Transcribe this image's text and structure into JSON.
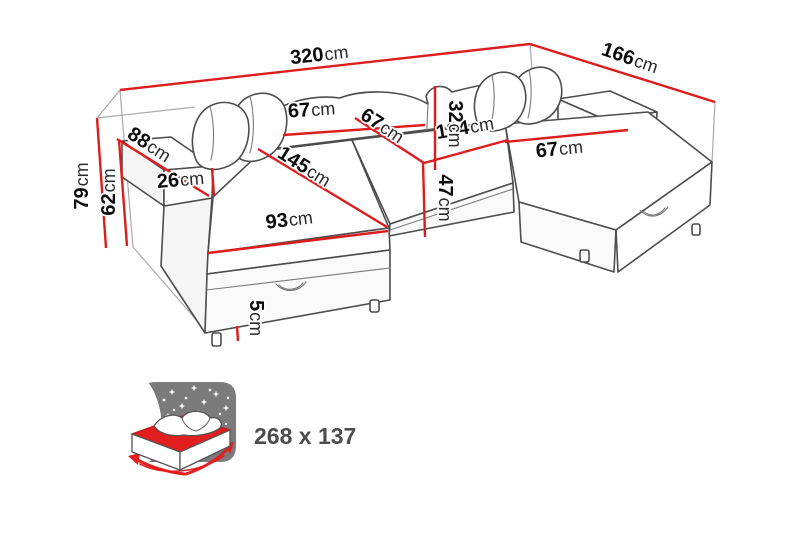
{
  "page": {
    "background": "#ffffff"
  },
  "diagram": {
    "type": "furniture-dimension-diagram",
    "subject": "u-shaped-corner-sofa",
    "colors": {
      "dimension_line": "#de1c1c",
      "outline": "#4d4d4d",
      "guide": "#ababab",
      "icon_gray": "#7b7b7b",
      "icon_red": "#e31e1e",
      "label_text": "#0c0c0c"
    },
    "dimensions": [
      {
        "id": "overall-width",
        "value": "320",
        "unit": "cm"
      },
      {
        "id": "overall-depth",
        "value": "166",
        "unit": "cm"
      },
      {
        "id": "overall-height",
        "value": "79",
        "unit": "cm"
      },
      {
        "id": "base-height",
        "value": "62",
        "unit": "cm"
      },
      {
        "id": "armrest-length",
        "value": "88",
        "unit": "cm"
      },
      {
        "id": "armrest-height",
        "value": "26",
        "unit": "cm"
      },
      {
        "id": "chaise-length",
        "value": "145",
        "unit": "cm"
      },
      {
        "id": "chaise-width",
        "value": "93",
        "unit": "cm"
      },
      {
        "id": "back-cushion-width",
        "value": "67",
        "unit": "cm"
      },
      {
        "id": "center-seat-width",
        "value": "67",
        "unit": "cm"
      },
      {
        "id": "center-section-length",
        "value": "134",
        "unit": "cm"
      },
      {
        "id": "backrest-cushion-height",
        "value": "32",
        "unit": "cm"
      },
      {
        "id": "seat-front-height",
        "value": "47",
        "unit": "cm"
      },
      {
        "id": "right-chaise-seat-width",
        "value": "67",
        "unit": "cm"
      },
      {
        "id": "leg-height",
        "value": "5",
        "unit": "cm"
      }
    ],
    "sleeping_function": {
      "icon": "sofa-bed-function-icon",
      "label": "268 x 137"
    }
  }
}
